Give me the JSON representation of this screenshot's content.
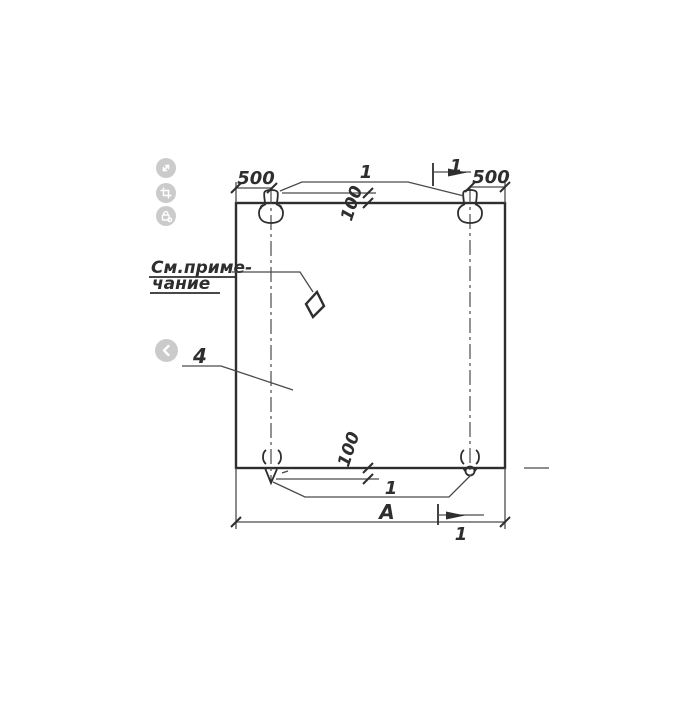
{
  "viewer": {
    "buttons": [
      {
        "name": "expand"
      },
      {
        "name": "crop"
      },
      {
        "name": "protect"
      },
      {
        "name": "previous"
      }
    ],
    "button_color": "#c7c7c7"
  },
  "drawing": {
    "labels": {
      "dim_500_left": "500",
      "dim_500_right": "500",
      "dim_100_top": "100",
      "dim_100_bottom": "100",
      "dim_width": "А",
      "callout_loops_top": "1",
      "callout_loops_bottom": "1",
      "callout_panel": "4",
      "section_mark_top": "1",
      "section_mark_bottom": "1",
      "note_line1": "См.приме-",
      "note_line2": "чание"
    },
    "colors": {
      "ink": "#2e2e2e",
      "thin_line": "#4a4a4a",
      "background": "#ffffff"
    }
  }
}
